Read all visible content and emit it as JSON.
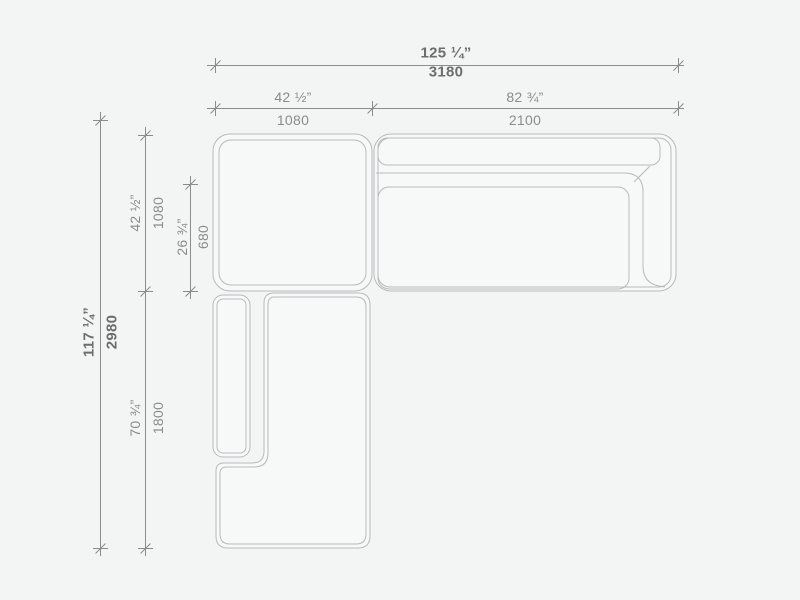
{
  "drawing": {
    "description": "Sectional sofa top-view dimension drawing",
    "units": [
      "inches",
      "millimeters"
    ],
    "colors": {
      "background": "#f3f4f4",
      "module_fill": "#f7f8f8",
      "module_outline": "#b7babb",
      "dimension_line": "#8c8c8c",
      "label_primary": "#6d6d6d",
      "label_secondary": "#8b8b8b"
    },
    "dims": {
      "overall_width": {
        "in": "125 ¼”",
        "mm": "3180"
      },
      "module_a_width": {
        "in": "42 ½”",
        "mm": "1080"
      },
      "module_b_width": {
        "in": "82 ¾”",
        "mm": "2100"
      },
      "overall_depth": {
        "in": "117 ¼”",
        "mm": "2980"
      },
      "module_a_depth": {
        "in": "42 ½”",
        "mm": "1080"
      },
      "seat_depth": {
        "in": "26 ¾”",
        "mm": "680"
      },
      "module_c_length": {
        "in": "70 ¾”",
        "mm": "1800"
      }
    }
  }
}
